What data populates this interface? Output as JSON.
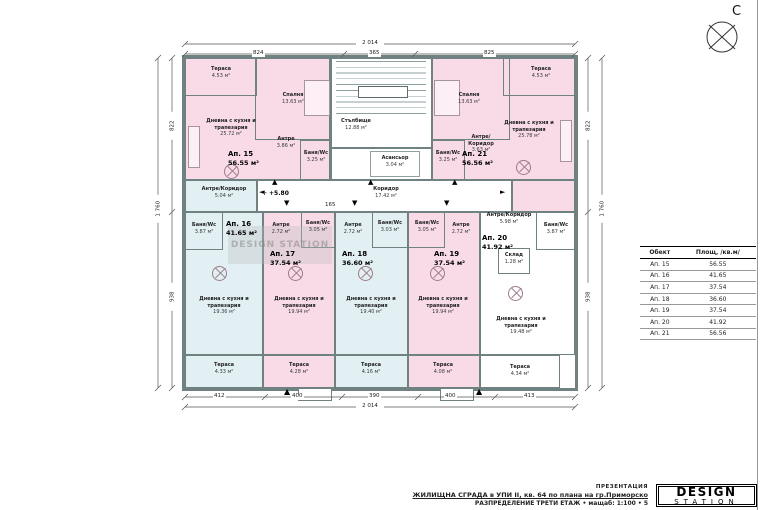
{
  "compass": {
    "north_letter": "С"
  },
  "icons": {
    "up_arrow": "▲",
    "down_arrow": "▼",
    "left_arrow": "◄",
    "right_arrow": "►",
    "entrance_arrow": "▲",
    "level_marker": "✛"
  },
  "levels": {
    "floor_level": "+5.80",
    "corridor_dim": "165"
  },
  "dimensions": {
    "top_total": "2 014",
    "top_seg1": "824",
    "top_seg2": "365",
    "top_seg3": "825",
    "bottom_seg1": "412",
    "bottom_seg2": "400",
    "bottom_seg3": "390",
    "bottom_seg4": "400",
    "bottom_seg5": "413",
    "bottom_total": "2 014",
    "left_seg1": "822",
    "left_seg2": "938",
    "left_total": "1 760",
    "right_seg1": "822",
    "right_seg2": "938",
    "right_total": "1 760"
  },
  "apartments": {
    "a15": {
      "id": "Ап. 15",
      "area": "56.55 м²"
    },
    "a16": {
      "id": "Ап. 16",
      "area": "41.65 м²"
    },
    "a17": {
      "id": "Ап. 17",
      "area": "37.54 м²"
    },
    "a18": {
      "id": "Ап. 18",
      "area": "36.60 м²"
    },
    "a19": {
      "id": "Ап. 19",
      "area": "37.54 м²"
    },
    "a20": {
      "id": "Ап. 20",
      "area": "41.92 м²"
    },
    "a21": {
      "id": "Ап. 21",
      "area": "56.56 м²"
    }
  },
  "rooms": {
    "a15_terrace": {
      "name": "Тераса",
      "area": "4.53 м²"
    },
    "a15_bedroom": {
      "name": "Спалня",
      "area": "13.63 м²"
    },
    "a15_living": {
      "name": "Дневна с кухня и трапезария",
      "area": "25.72 м²"
    },
    "a15_antre": {
      "name": "Антре",
      "area": "3.86 м²"
    },
    "a15_bath": {
      "name": "Баня/Wc",
      "area": "3.25 м²"
    },
    "a21_terrace": {
      "name": "Тераса",
      "area": "4.53 м²"
    },
    "a21_bedroom": {
      "name": "Спалня",
      "area": "13.63 м²"
    },
    "a21_living": {
      "name": "Дневна с кухня и трапезария",
      "area": "25.78 м²"
    },
    "a21_antre": {
      "name": "Антре/Коридор",
      "area": "3.63 м²"
    },
    "a21_bath": {
      "name": "Баня/Wc",
      "area": "3.25 м²"
    },
    "stairs": {
      "name": "Стълбище",
      "area": "12.88 м²"
    },
    "elevator": {
      "name": "Асансьор",
      "area": "3.04 м²"
    },
    "corridor": {
      "name": "Коридор",
      "area": "17.42 м²"
    },
    "a16_antre": {
      "name": "Антре/Коридор",
      "area": "5.04 м²"
    },
    "a16_bath": {
      "name": "Баня/Wc",
      "area": "3.87 м²"
    },
    "a16_living": {
      "name": "Дневна с кухня и трапезария",
      "area": "19.36 м²"
    },
    "a16_terrace": {
      "name": "Тераса",
      "area": "4.33 м²"
    },
    "a17_antre": {
      "name": "Антре",
      "area": "2.72 м²"
    },
    "a17_bath": {
      "name": "Баня/Wc",
      "area": "3.05 м²"
    },
    "a17_living": {
      "name": "Дневна с кухня и трапезария",
      "area": "19.94 м²"
    },
    "a17_terrace": {
      "name": "Тераса",
      "area": "4.28 м²"
    },
    "a18_antre": {
      "name": "Антре",
      "area": "2.72 м²"
    },
    "a18_bath": {
      "name": "Баня/Wc",
      "area": "3.03 м²"
    },
    "a18_living": {
      "name": "Дневна с кухня и трапезария",
      "area": "19.40 м²"
    },
    "a18_terrace": {
      "name": "Тераса",
      "area": "4.16 м²"
    },
    "a19_antre": {
      "name": "Антре",
      "area": "2.72 м²"
    },
    "a19_bath": {
      "name": "Баня/Wc",
      "area": "3.05 м²"
    },
    "a19_living": {
      "name": "Дневна с кухня и трапезария",
      "area": "19.94 м²"
    },
    "a19_terrace": {
      "name": "Тераса",
      "area": "4.08 м²"
    },
    "a20_antre": {
      "name": "Антре/Коридор",
      "area": "5.98 м²"
    },
    "a20_bath": {
      "name": "Баня/Wc",
      "area": "3.87 м²"
    },
    "a20_storage": {
      "name": "Склад",
      "area": "1.28 м²"
    },
    "a20_living": {
      "name": "Дневна с кухня и трапезария",
      "area": "19.48 м²"
    },
    "a20_terrace": {
      "name": "Тераса",
      "area": "4.34 м²"
    }
  },
  "table": {
    "headers": {
      "object": "Обект",
      "area": "Площ, /кв.м/"
    },
    "rows": [
      [
        "Ап. 15",
        "56.55"
      ],
      [
        "Ап. 16",
        "41.65"
      ],
      [
        "Ап. 17",
        "37.54"
      ],
      [
        "Ап. 18",
        "36.60"
      ],
      [
        "Ап. 19",
        "37.54"
      ],
      [
        "Ап. 20",
        "41.92"
      ],
      [
        "Ап. 21",
        "56.56"
      ]
    ]
  },
  "title_block": {
    "presentation": "ПРЕЗЕНТАЦИЯ",
    "project": "ЖИЛИЩНА СГРАДА в УПИ II, кв. 64 по плана на гр.Приморско",
    "sheet": "РАЗПРЕДЕЛЕНИЕ ТРЕТИ ЕТАЖ • мащаб: 1:100 • 5",
    "logo_top": "DESIGN",
    "logo_bottom": "STATION"
  },
  "watermark": {
    "text": "DESIGN STATION"
  },
  "colors": {
    "apartment_pink": "#f9dbe8",
    "apartment_blue": "#e2f0f4",
    "wall": "#6f8181"
  }
}
